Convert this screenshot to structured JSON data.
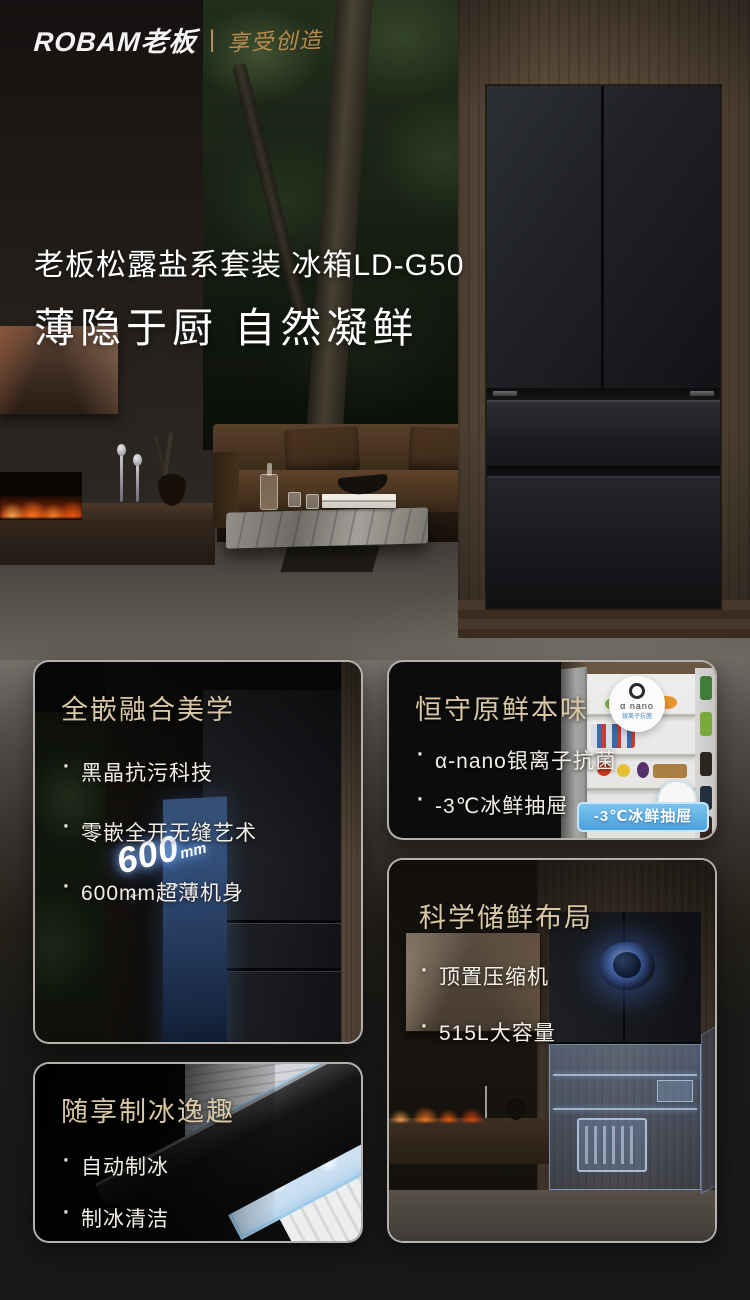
{
  "brand": {
    "logo": "ROBAM老板",
    "divider": "|",
    "slogan": "享受创造"
  },
  "hero": {
    "title_line1": "老板松露盐系套装 冰箱LD-G50",
    "title_line2": "薄隐于厨 自然凝鲜"
  },
  "cards": [
    {
      "title": "全嵌融合美学",
      "bullets": [
        "黑晶抗污科技",
        "零嵌全开无缝艺术",
        "600mm超薄机身"
      ],
      "badge": {
        "value": "600",
        "unit": "mm",
        "arrows": "← →"
      }
    },
    {
      "title": "恒守原鲜本味",
      "bullets": [
        "α-nano银离子抗菌",
        "-3℃冰鲜抽屉",
        "高保湿养鲜"
      ],
      "nano_badge_line1": "α nano",
      "nano_badge_line2": "银离子抗菌",
      "drawer_label": "-3℃冰鲜抽屉"
    },
    {
      "title": "科学储鲜布局",
      "bullets": [
        "顶置压缩机",
        "515L大容量"
      ]
    },
    {
      "title": "随享制冰逸趣",
      "bullets": [
        "自动制冰",
        "制冰清洁"
      ]
    }
  ],
  "colors": {
    "accent_gold": "#d9c7a6",
    "text_light": "#f3efe7",
    "label_blue": "#4da0dc"
  }
}
